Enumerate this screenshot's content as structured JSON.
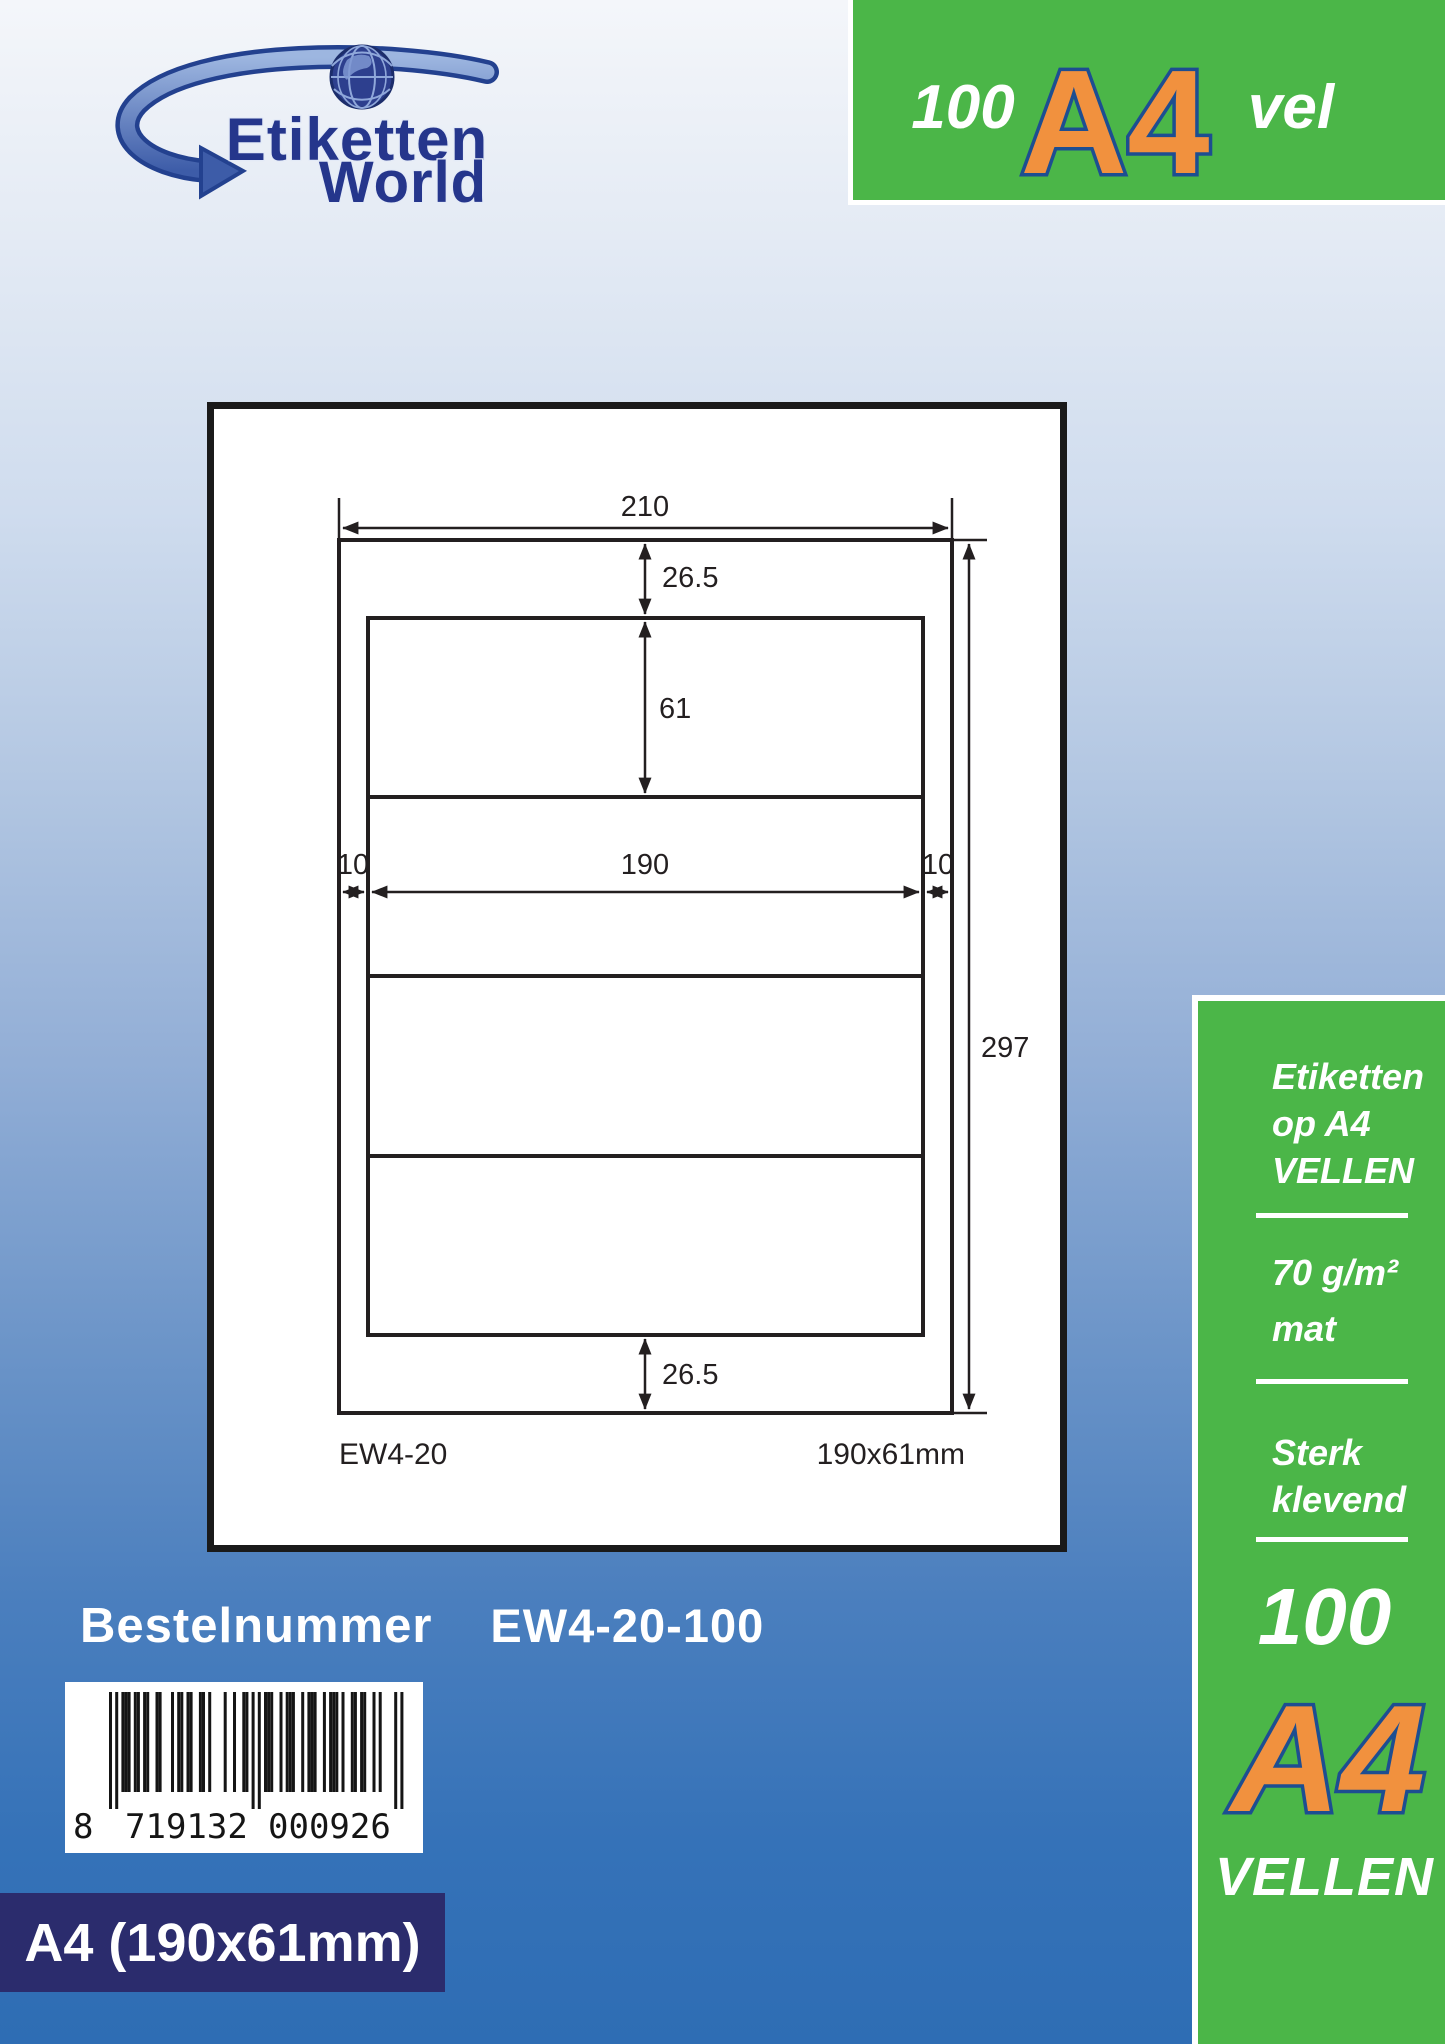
{
  "logo": {
    "line1": "Etiketten",
    "line2": "World"
  },
  "top_badge": {
    "count": "100",
    "format": "A4",
    "unit": "vel"
  },
  "diagram": {
    "dims": {
      "sheet_width": "210",
      "top_margin": "26.5",
      "label_height": "61",
      "left_margin": "10",
      "label_width": "190",
      "right_margin": "10",
      "sheet_height": "297",
      "bottom_margin": "26.5"
    },
    "product_code": "EW4-20",
    "label_size": "190x61mm",
    "labels_per_sheet": 4
  },
  "order": {
    "label": "Bestelnummer",
    "number": "EW4-20-100"
  },
  "barcode": {
    "prefix": "8",
    "group1": "719132",
    "group2": "000926",
    "value": "8719132000926",
    "modules": "10101110110110011000101101100110100001001001101010111001011100101110010111010011011001010000101",
    "guards": [
      0,
      2,
      46,
      48,
      92,
      94
    ]
  },
  "footer_badge": {
    "text": "A4 (190x61mm)"
  },
  "sidebar": {
    "headline": "Etiketten\nop A4\nVELLEN",
    "weight": "70  g/m²",
    "finish": "mat",
    "adhesive": "Sterk\nklevend",
    "count": "100",
    "format": "A4",
    "unit": "VELLEN"
  },
  "colors": {
    "green": "#4bb648",
    "orange": "#f1913e",
    "orange-outline": "#1d4e91",
    "navy": "#2b2c6d",
    "logo-navy": "#25368c",
    "swoosh-light": "#7b9cd4",
    "swoosh-dark": "#2c4a94",
    "line": "#231f20"
  }
}
